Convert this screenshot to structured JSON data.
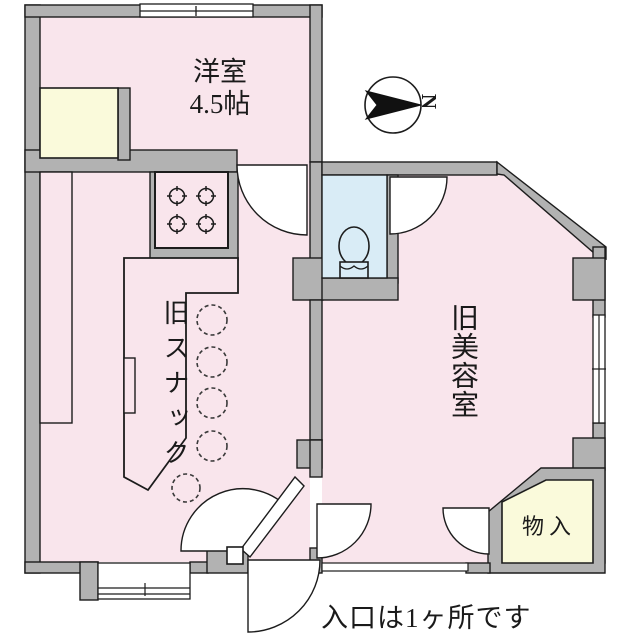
{
  "title": "間取り図",
  "rooms": [
    {
      "name": "洋室",
      "size": "4.5帖"
    },
    {
      "name": "旧スナック"
    },
    {
      "name": "旧美容室"
    },
    {
      "name": "物入"
    }
  ],
  "annotation": "入口は1ヶ所です",
  "compass": {
    "label": "N"
  },
  "colors": {
    "floor_pink": "#f9e5ec",
    "closet_cream": "#fafadb",
    "toilet_blue": "#d9ecf6",
    "wall_gray": "#b2b2b2",
    "line_black": "#1c1c1c",
    "door_white": "#ffffff"
  },
  "fixtures": [
    "compass",
    "sliding-window",
    "gas-stove",
    "toilet",
    "bar-counter",
    "bar-stools",
    "hinged-doors",
    "storage"
  ]
}
